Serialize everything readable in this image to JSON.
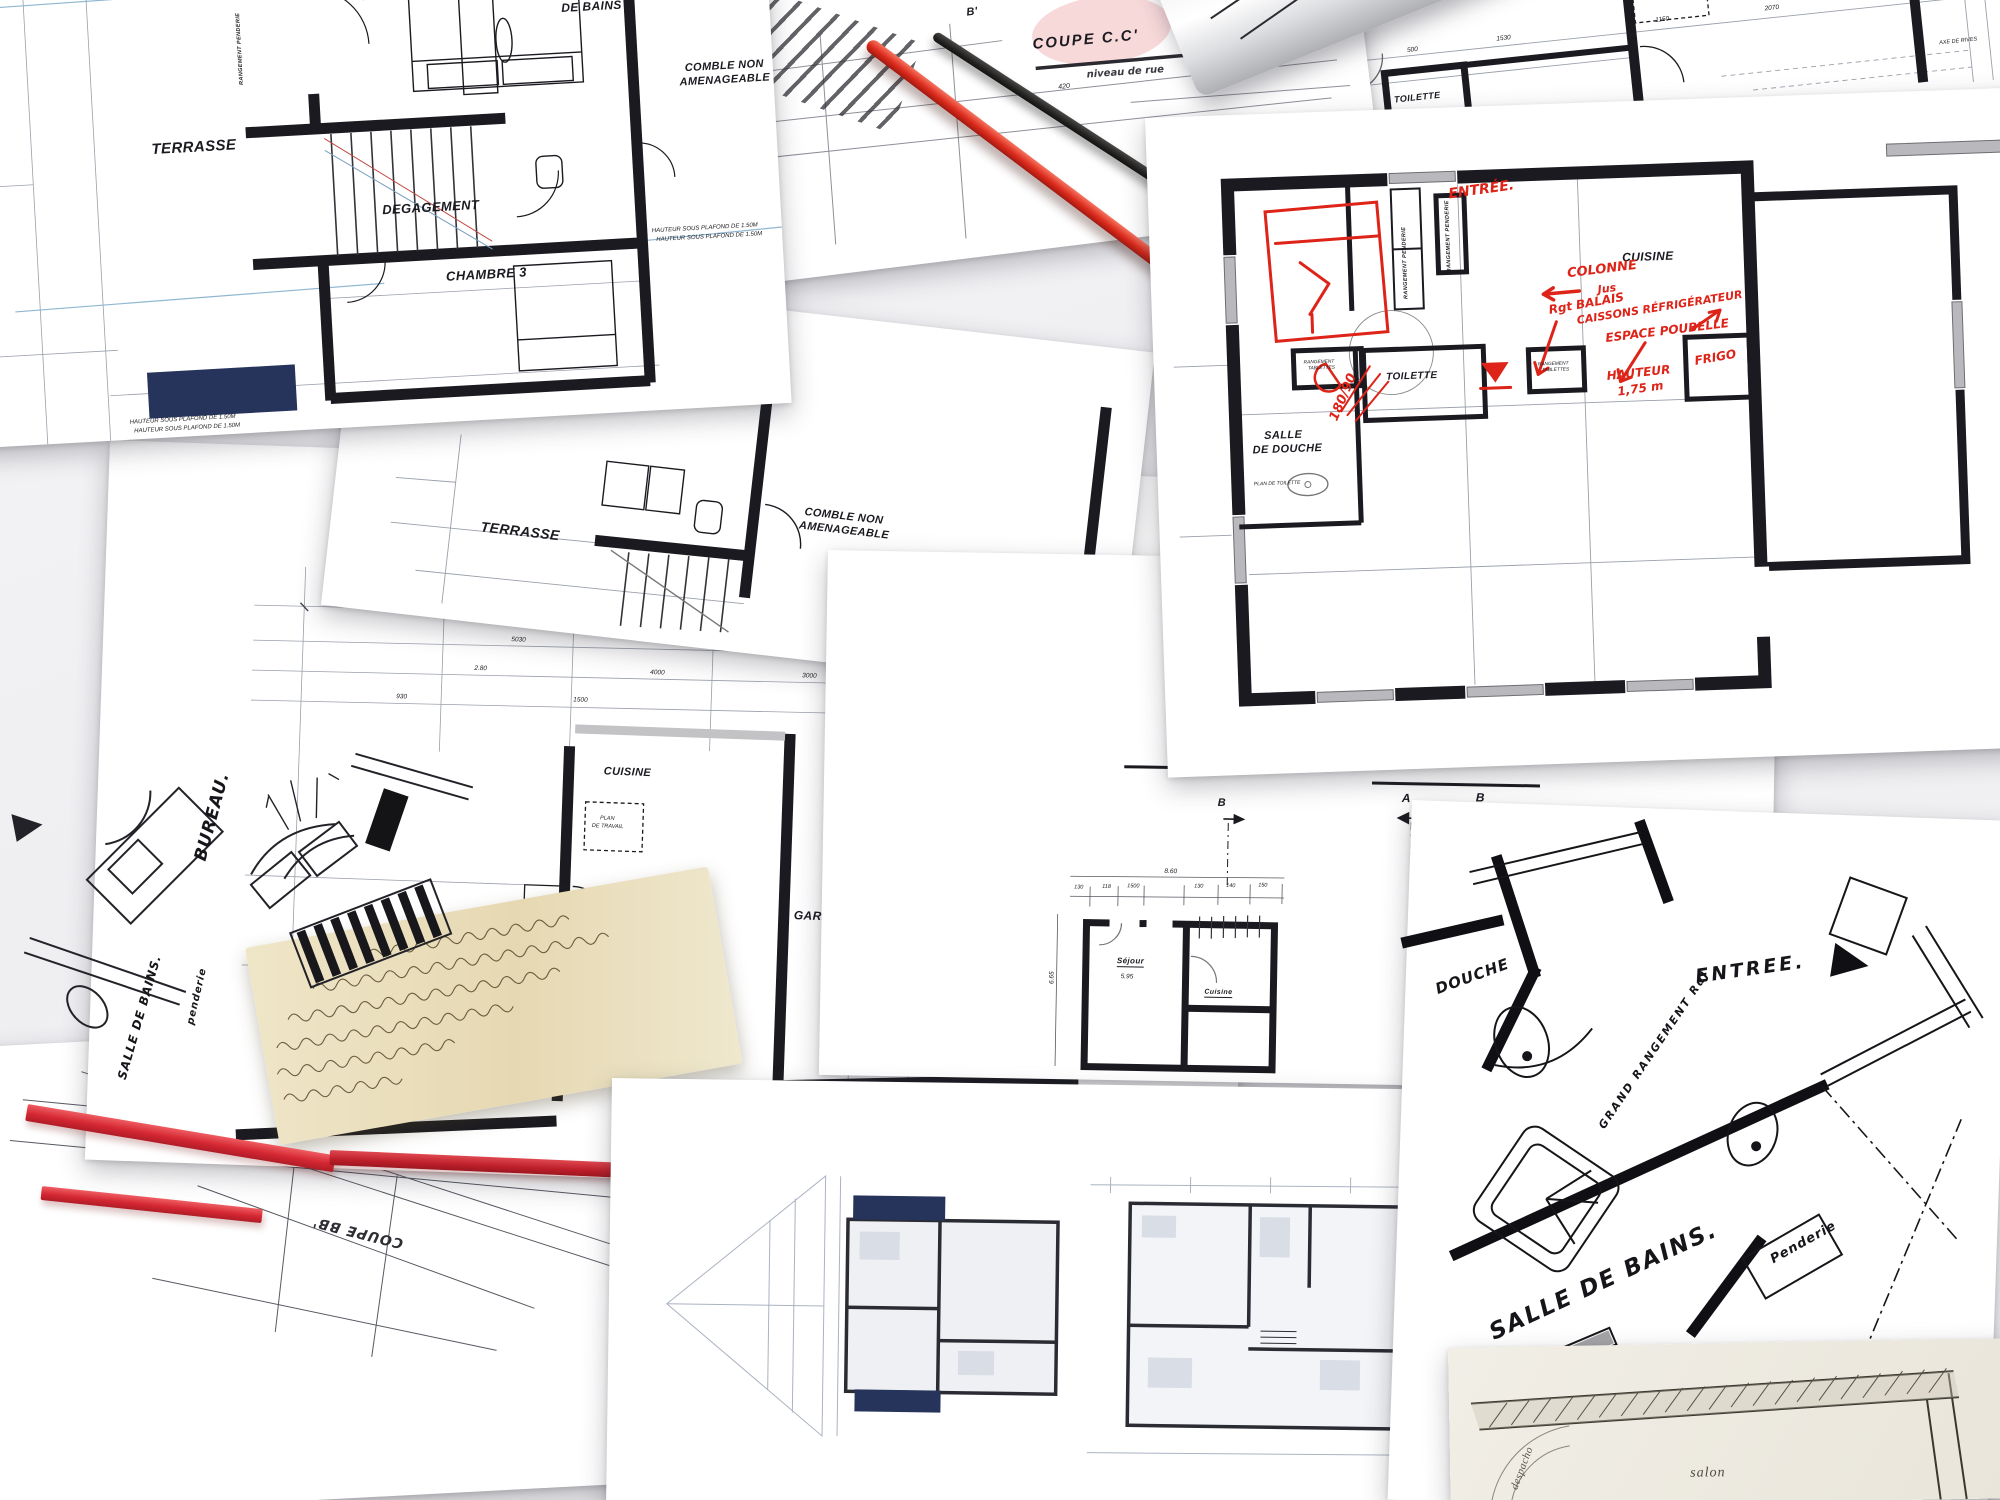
{
  "palette": {
    "paper": "#ffffff",
    "ink": "#1a1a20",
    "red": "#de2418",
    "tape_red": "#d42733",
    "navy": "#26345c",
    "blue_line": "#8fb7d2",
    "beige_note": "#e9dcb8",
    "gray_line": "#9aa0aa"
  },
  "s1": {
    "chambre2": "CHAMBRE 2",
    "salle1": "SALLE",
    "salle2": "DE BAINS",
    "comble1": "COMBLE NON",
    "comble2": "AMENAGEABLE",
    "terrasse": "TERRASSE",
    "degagement": "DEGAGEMENT",
    "chambre3": "CHAMBRE 3",
    "note": "HAUTEUR SOUS PLAFOND DE 1.50M",
    "rangement": "RANGEMENT PENDERIE"
  },
  "s2": {
    "title": "COUPE C.C'",
    "b": "B'",
    "niveau": "niveau de rue",
    "level": "0.00",
    "d1": "2700",
    "d2": "420"
  },
  "s3": {
    "cuisine": "CUISINE",
    "plan1": "PLAN",
    "plan2": "DE TRAVAIL",
    "toilette": "TOILETTE",
    "garage": "GARAGE",
    "axe": "AXE DE RIVES",
    "d1": "500",
    "d2": "1530",
    "d3": "1150",
    "d4": "2070",
    "d5": "900"
  },
  "s4": {
    "printed": {
      "cuisine": "CUISINE",
      "toilette": "TOILETTE",
      "douche1": "SALLE",
      "douche2": "DE DOUCHE",
      "rangement_penderie": "RANGEMENT PENDERIE",
      "rangement_tablettes1": "RANGEMENT",
      "rangement_tablettes2": "TABLETTES",
      "plan_toilette": "PLAN DE TOILETTE"
    },
    "hand": {
      "entree": "ENTRÉE.",
      "colonne1": "COLONNE",
      "colonne2": "Jus",
      "rgt1": "Rgt BALAIS",
      "rgt2": "CAISSONS RÉFRIGÉRATEUR",
      "espace": "ESPACE POUBELLE",
      "hauteur1": "HAUTEUR",
      "hauteur2": "1,75 m",
      "frigo": "FRIGO",
      "douche_dim": "180/90"
    }
  },
  "s5": {
    "terrasse": "TERRASSE",
    "comble1": "COMBLE NON",
    "comble2": "AMENAGEABLE"
  },
  "s6": {
    "cuisine": "CUISINE",
    "plan1": "PLAN",
    "plan2": "DE TRAVAIL",
    "garage": "GARAGE",
    "salon": "SALON",
    "d": [
      "11400",
      "6220",
      "5030",
      "4000",
      "3000",
      "1500",
      "930",
      "450",
      "2.80"
    ]
  },
  "s7": {
    "bureau": "BUREAU.",
    "sdb": "SALLE DE BAINS.",
    "penderie": "penderie"
  },
  "s9": {
    "aa": "A.A'",
    "bb": "COUPE B.B'",
    "ma": "A",
    "mb": "B",
    "total": "8.60",
    "h": "6.65",
    "sejour": "Séjour",
    "sejourd": "5.95",
    "cuisine": "Cuisine",
    "d": [
      "130",
      "118",
      "1500",
      "130",
      "140",
      "150"
    ],
    "flip": "COUPE BB'"
  },
  "s11": {
    "entree": "ENTREE.",
    "douche": "DOUCHE",
    "grand": "GRAND RANGEMENT RdJ",
    "sdb": "SALLE DE BAINS.",
    "porte1": "Porte",
    "porte2": "Serviette.",
    "penderie": "Penderie"
  },
  "s12": {
    "salon": "salon",
    "despacho": "despacho"
  }
}
